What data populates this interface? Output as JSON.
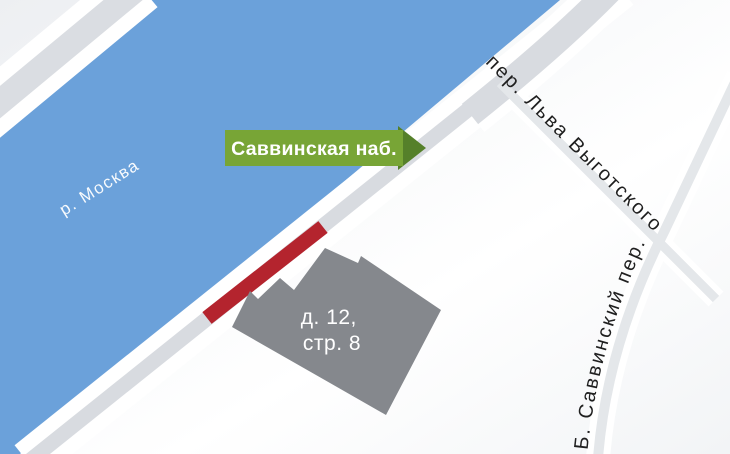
{
  "labels": {
    "river": "р. Москва",
    "badge": "Саввинская наб.",
    "street_lva_vygotskogo": "пер. Льва Выготского",
    "street_b_savvinsky": "Б. Саввинский пер.",
    "building_line1": "д. 12,",
    "building_line2": "стр. 8"
  },
  "colors": {
    "river": "#6ba1da",
    "road": "#d8dbe0",
    "road_secondary": "#dadde2",
    "road_minor": "#e4e7ea",
    "building": "#85888d",
    "highlight_red": "#b4242e",
    "badge_green": "#78a536",
    "badge_arrow_green": "#55802a",
    "street_label": "#1f1f1f",
    "label_white": "#ffffff"
  }
}
